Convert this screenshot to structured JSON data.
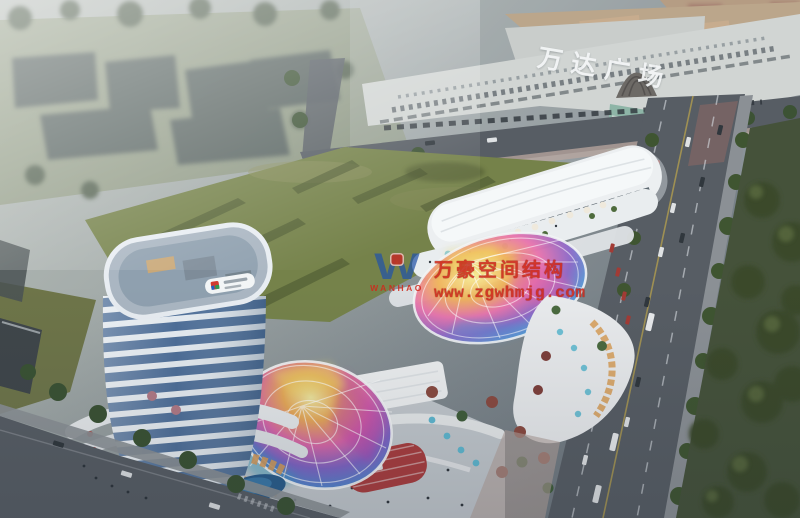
{
  "signage": {
    "mall_sign": "万达广场"
  },
  "watermark": {
    "logo_letter": "W",
    "brand": "WANHAO",
    "company": "万豪空间结构",
    "website": "www.zgwhmjg.com"
  },
  "palette": {
    "watermark-red": "#cf2a1c",
    "logo-blue": "#2353a8",
    "sign-white": "#f4f6f7",
    "field-green": "#75824a",
    "park-green": "#45523a",
    "road-gray": "#575d64",
    "sidewalk-gray": "#8b9095",
    "tower-band": "#e7edf2",
    "tower-glass": "#4e6f99",
    "mall-roof-tan": "#b79b78",
    "mall-facade": "#d3d6d3",
    "warm-storefront": "#d29a5c",
    "accent-red-building": "#a93d3e",
    "canopy-yellow": "#f0dc6a",
    "canopy-pink": "#e060a8",
    "canopy-purple": "#8f63c6",
    "canopy-blue": "#4f8fd4",
    "canopy-teal": "#49c2c9"
  }
}
